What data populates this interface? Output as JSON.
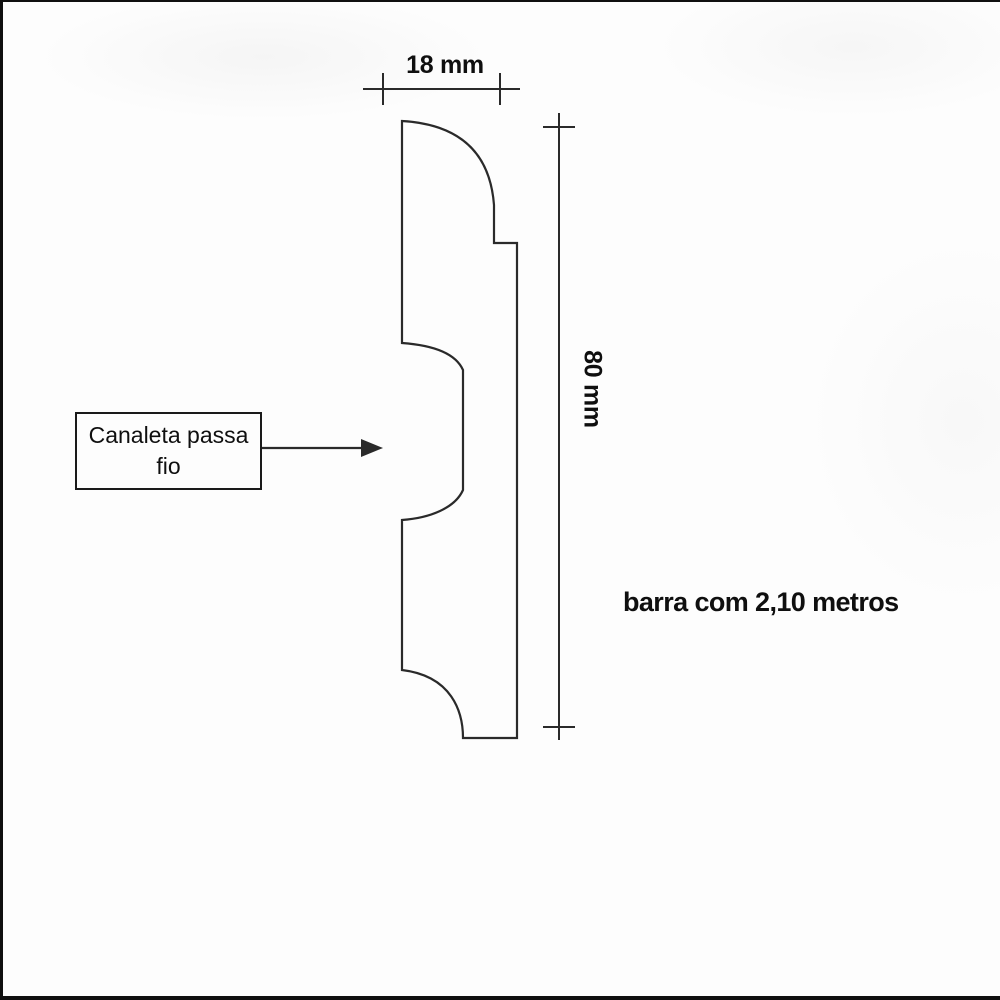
{
  "figure": {
    "width_dimension": {
      "label": "18 mm"
    },
    "height_dimension": {
      "label": "80 mm"
    },
    "callout": {
      "line1": "Canaleta passa",
      "line2": "fio"
    },
    "length_note": "barra com 2,10 metros"
  },
  "icons": {
    "callout_arrow": "arrow-right"
  },
  "colors": {
    "line": "#2a2a2a",
    "text": "#0f0f0f",
    "background": "#fdfdfd"
  }
}
